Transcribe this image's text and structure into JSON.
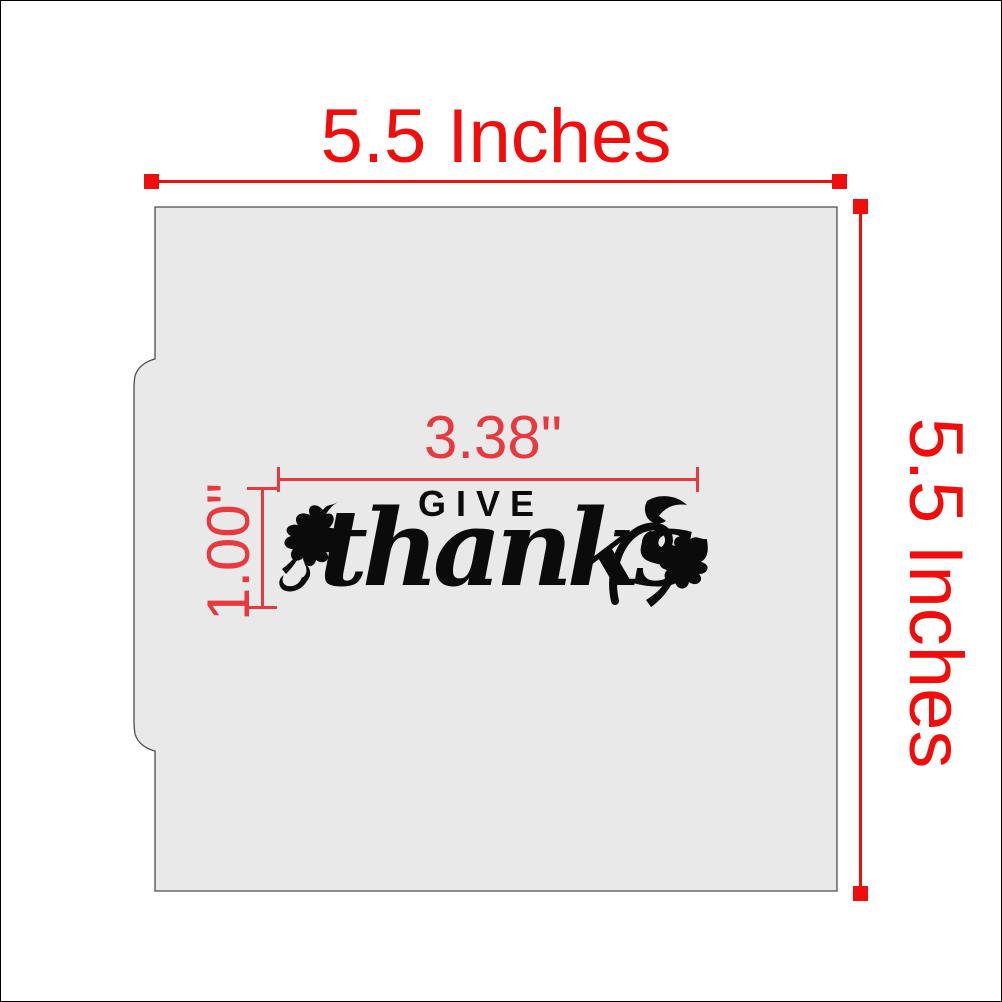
{
  "colors": {
    "red_outer": "#f20d0d",
    "red_inner": "#e8393e",
    "stencil_fill": "#e9e9e9",
    "stencil_stroke": "#4d4d4d",
    "ink": "#0b0b0b"
  },
  "dimensions": {
    "overall_width": {
      "label": "5.5 Inches"
    },
    "overall_height": {
      "label": "5.5 Inches"
    },
    "design_width": {
      "label": "3.38\""
    },
    "design_height": {
      "label": "1.00\""
    }
  },
  "design": {
    "word_top": "GIVE",
    "word_main": "thanks"
  },
  "icons": {
    "left_ornament": "oak-leaf-with-flourish",
    "right_ornament_swirl": "flourish-swirl",
    "right_ornament_top": "small-leaf",
    "right_ornament_bottom": "oak-leaf"
  }
}
